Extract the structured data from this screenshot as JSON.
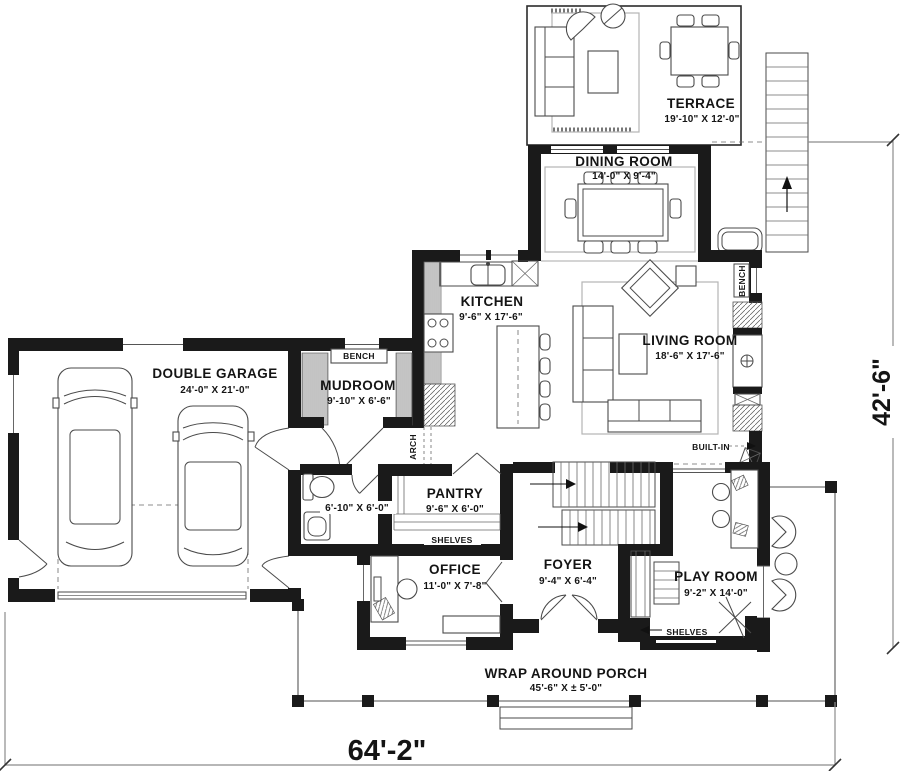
{
  "rooms": {
    "terrace": {
      "name": "TERRACE",
      "dims": "19'-10\" X 12'-0\""
    },
    "dining": {
      "name": "DINING ROOM",
      "dims": "14'-0\" X 9'-4\""
    },
    "kitchen": {
      "name": "KITCHEN",
      "dims": "9'-6\" X 17'-6\""
    },
    "living": {
      "name": "LIVING ROOM",
      "dims": "18'-6\" X 17'-6\""
    },
    "garage": {
      "name": "DOUBLE GARAGE",
      "dims": "24'-0\" X 21'-0\""
    },
    "mudroom": {
      "name": "MUDROOM",
      "dims": "9'-10\" X 6'-6\""
    },
    "powder": {
      "dims": "6'-10\" X 6'-0\""
    },
    "pantry": {
      "name": "PANTRY",
      "dims": "9'-6\" X 6'-0\""
    },
    "office": {
      "name": "OFFICE",
      "dims": "11'-0\" X 7'-8\""
    },
    "foyer": {
      "name": "FOYER",
      "dims": "9'-4\" X 6'-4\""
    },
    "playroom": {
      "name": "PLAY ROOM",
      "dims": "9'-2\" X 14'-0\""
    },
    "porch": {
      "name": "WRAP AROUND PORCH",
      "dims": "45'-6\" X ± 5'-0\""
    }
  },
  "annotations": {
    "bench_mudroom": "BENCH",
    "bench_living": "BENCH",
    "arch": "ARCH",
    "shelves_pantry": "SHELVES",
    "shelves_playroom": "SHELVES",
    "built_in": "BUILT-IN"
  },
  "overall_dimensions": {
    "width": "64'-2\"",
    "height": "42'-6\""
  },
  "colors": {
    "walls": "#1a1a1a",
    "background": "#ffffff",
    "porch_lines": "#8c8c8c"
  }
}
